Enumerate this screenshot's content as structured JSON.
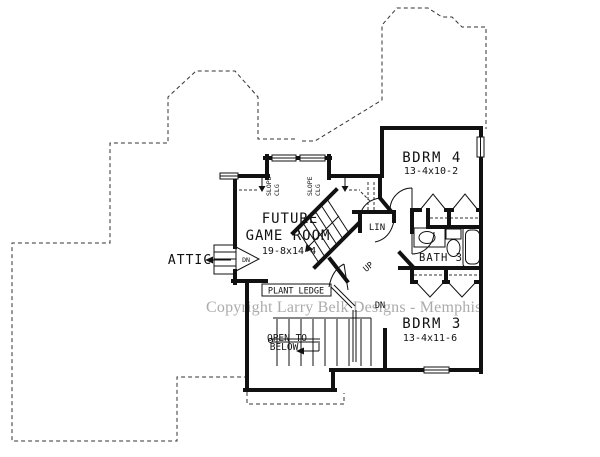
{
  "watermark": "Copyright Larry Belk Designs - Memphis",
  "rooms": {
    "game_room": {
      "name_line1": "FUTURE",
      "name_line2": "GAME ROOM",
      "dims": "19-8x14-4"
    },
    "bdrm4": {
      "name": "BDRM 4",
      "dims": "13-4x10-2"
    },
    "bath3": {
      "name": "BATH 3"
    },
    "bdrm3": {
      "name": "BDRM 3",
      "dims": "13-4x11-6"
    },
    "attic": {
      "name": "ATTIC"
    },
    "open_below": {
      "line1": "OPEN TO",
      "line2": "BELOW"
    }
  },
  "labels": {
    "plant_ledge": "PLANT LEDGE",
    "lin": "LIN",
    "up": "UP",
    "dn_stairs": "DN",
    "dn_attic": "DN",
    "slope_line1": "SLOPE",
    "slope_line2": "CLG"
  },
  "colors": {
    "wall": "#111111",
    "dashed_outline": "#333333",
    "watermark": "#ababab",
    "background": "#ffffff"
  }
}
